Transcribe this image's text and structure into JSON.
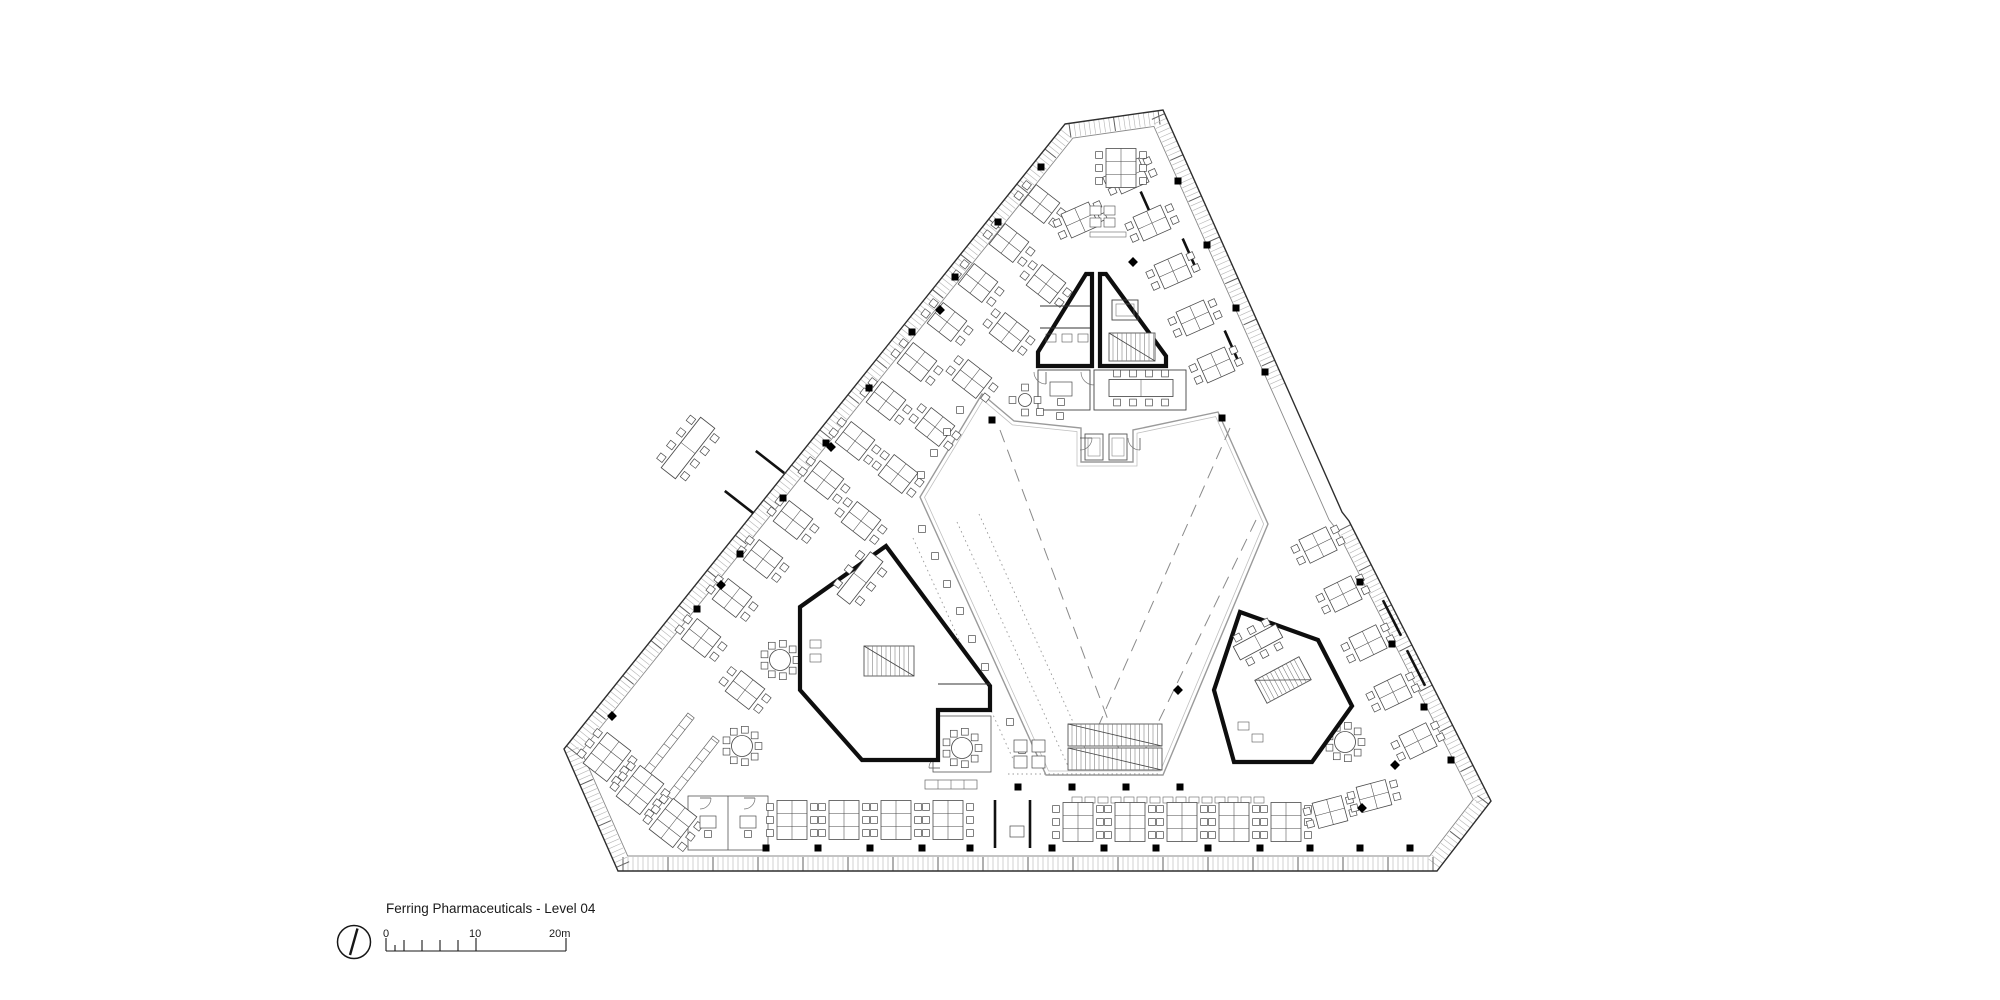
{
  "sheet": {
    "background": "#ffffff"
  },
  "title_block": {
    "title": "Ferring Pharmaceuticals - Level 04"
  },
  "scale_bar": {
    "tick_labels": [
      "0",
      "10",
      "20m"
    ]
  },
  "icons": {
    "north_arrow": "north-arrow-icon"
  },
  "colors": {
    "paper": "#ffffff",
    "ink": "#1c1c1c",
    "core_wall": "#0e0e0e",
    "furniture": "#4a4a4a",
    "facade_edge": "#2e2e2e",
    "facade_tick": "#b8b8b8",
    "inner_edge": "#8a8a8a",
    "atrium_line": "#9a9a9a",
    "dash_line": "#8a8a8a",
    "dot_line": "#9a9a9a",
    "column": "#000000"
  }
}
